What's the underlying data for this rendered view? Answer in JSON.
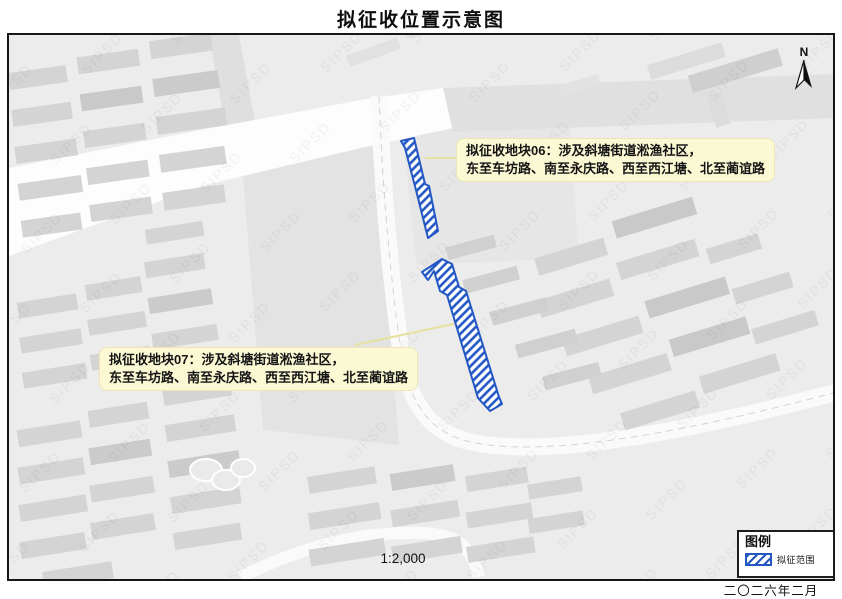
{
  "title": "拟征收位置示意图",
  "map": {
    "scale_label": "1:2,000",
    "north_label": "N",
    "watermark": "SIPSD",
    "callouts": [
      {
        "id": "06",
        "line1": "拟征收地块06：涉及斜塘街道淞渔社区，",
        "line2": "东至车坊路、南至永庆路、西至西江塘、北至蔺谊路"
      },
      {
        "id": "07",
        "line1": "拟征收地块07：涉及斜塘街道淞渔社区，",
        "line2": "东至车坊路、南至永庆路、西至西江塘、北至蔺谊路"
      }
    ]
  },
  "legend": {
    "title": "图例",
    "items": [
      {
        "label": "拟征范围",
        "symbol": "blue-diagonal-hatch-icon"
      }
    ]
  },
  "footer": {
    "date": "二〇二六年二月"
  },
  "colors": {
    "hatch_blue": "#2257c4",
    "callout_bg": "#fbf8d4",
    "map_bg": "#ececec",
    "building_gray": "#d4d4d4",
    "road_white": "#fafafa"
  }
}
